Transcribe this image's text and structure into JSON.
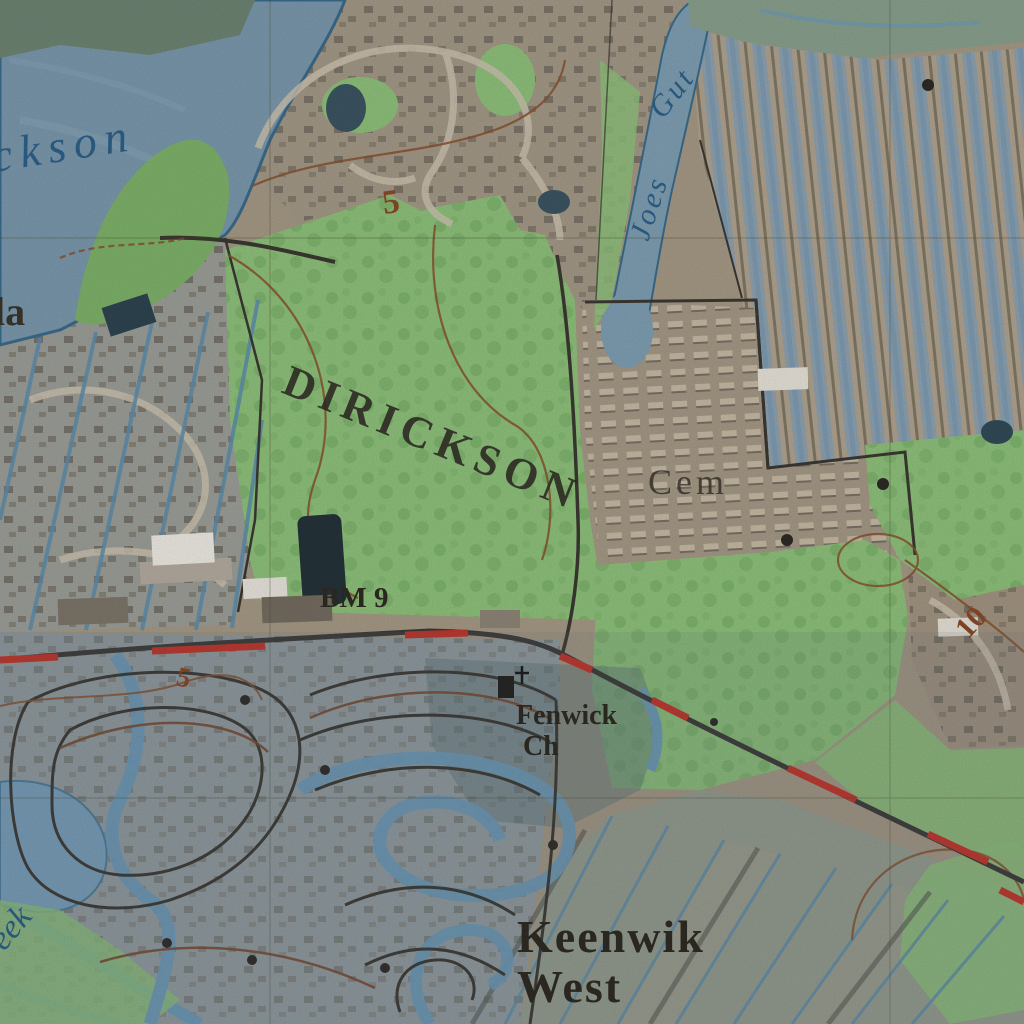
{
  "map": {
    "labels": {
      "water_body_partial": "ckson",
      "place_left_partial": "la",
      "area_name": "DIRICKSON",
      "stream_word1": "Joes",
      "stream_word2": "Gut",
      "cemetery": "Cem",
      "benchmark": "BM 9",
      "church_line1": "Fenwick",
      "church_line2": "Ch",
      "neighborhood_line1": "Keenwik",
      "neighborhood_line2": "West",
      "contour_top": "5",
      "contour_mid": "5",
      "contour_right": "10",
      "water_bottom_partial": "eek"
    },
    "colors": {
      "land_base": "#a79a86",
      "water": "#7b99ad",
      "shoreline": "#3a6c8d",
      "vegetation": "#8fc27c",
      "vegetation_dark": "#6aa35b",
      "development_tint": "#8fa3b0",
      "route_dash_red": "#c63428",
      "road_black": "#3c3832",
      "road_brown": "#7a4a30",
      "contour_brown": "#8a5230",
      "canal_blue": "#6f9cba",
      "label_black": "#2f2b24",
      "label_blue": "#2d618a"
    }
  }
}
